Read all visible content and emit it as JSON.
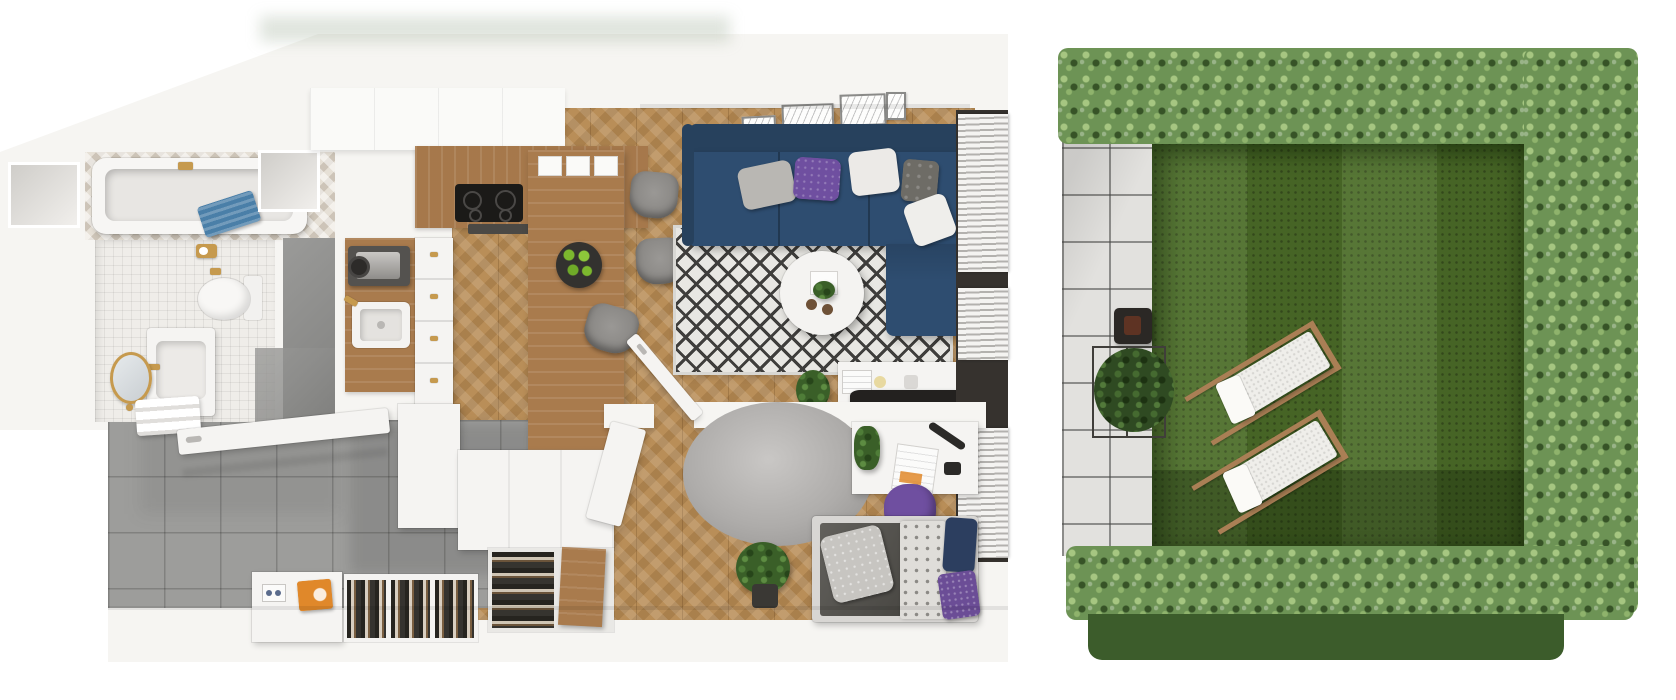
{
  "scene": {
    "description": "3D top-down cutaway render of a small apartment floor plan with a private garden",
    "view": "bird's-eye dollhouse render",
    "text_visible": "none"
  },
  "colors": {
    "wall": "#f6f5f2",
    "wall_shadow": "#dbd9d5",
    "wood": "#b98e58",
    "counter_wood": "#b08050",
    "gray_tile": "#9d9d9b",
    "concrete": "#8f8f8d",
    "mosaic": "#efede9",
    "navy": "#2e4d70",
    "navy_dark": "#27415d",
    "purple": "#6f4fa0",
    "gold": "#c69a4e",
    "orange": "#e0882a",
    "grass": "#4d6e29",
    "grass_dark": "#3a5522",
    "hedge": "#6d9355",
    "hedge_light": "#a6c681",
    "hedge_outer": "#3c5c2b",
    "patio": "#e2e1de",
    "lounger_wood": "#aa7f55",
    "tv_black": "#23211f",
    "rug_line": "#3f3e3c",
    "towel_blue": "#4a7fa8"
  },
  "apartment": {
    "rooms": [
      {
        "name": "bathroom",
        "floor": "white mosaic tile",
        "furniture": [
          "bathtub",
          "blue-towel",
          "chevron-tiled-wall",
          "toilet",
          "toilet-paper-holder",
          "vanity-sink",
          "gold-faucet",
          "round-gold-mirror",
          "towel-rail",
          "shower-area",
          "wall-niche-left",
          "wall-niche-right"
        ]
      },
      {
        "name": "kitchen",
        "floor": "herringbone oak parquet",
        "furniture": [
          "upper-cabinets",
          "wooden-countertop",
          "induction-hob",
          "cooker-hood",
          "coffee-machine",
          "kitchen-sink",
          "drawer-column",
          "low-cabinet",
          "dining-table",
          "dining-chair-1",
          "dining-chair-2",
          "dining-chair-3",
          "fruit-bowl-green-apples",
          "placemats"
        ]
      },
      {
        "name": "living-room",
        "floor": "herringbone oak parquet",
        "furniture": [
          "navy-sectional-sofa",
          "sofa-cushions",
          "diamond-pattern-rug",
          "round-coffee-table",
          "decor-tray-plant-candles",
          "tv-sideboard",
          "flat-tv",
          "picture-frames",
          "window-blinds",
          "floor-plant"
        ]
      },
      {
        "name": "sleeping-nook",
        "floor": "herringbone oak parquet",
        "furniture": [
          "partition-wall",
          "interior-door",
          "desk",
          "desk-lamp",
          "open-book",
          "desk-plant",
          "purple-chair",
          "bed",
          "dark-duvet",
          "patterned-blanket",
          "purple-pillows",
          "round-fluffy-rug",
          "potted-plant"
        ]
      },
      {
        "name": "hallway",
        "floor": "gray concrete tile",
        "furniture": [
          "entrance-door",
          "shoe-bench",
          "orange-box",
          "shoe-rack-1",
          "shoe-rack-2",
          "shoe-rack-3",
          "tall-shoe-cabinet",
          "cabinet-wood-door",
          "open-cabinet-door"
        ]
      }
    ]
  },
  "garden": {
    "features": [
      "patio-tiles",
      "lawn-with-mowing-stripes",
      "hedge-top",
      "hedge-right",
      "hedge-bottom",
      "hedge-outer-shadow-band",
      "lantern",
      "wire-side-table",
      "potted-shrub",
      "sun-lounger-1",
      "sun-lounger-2"
    ]
  }
}
